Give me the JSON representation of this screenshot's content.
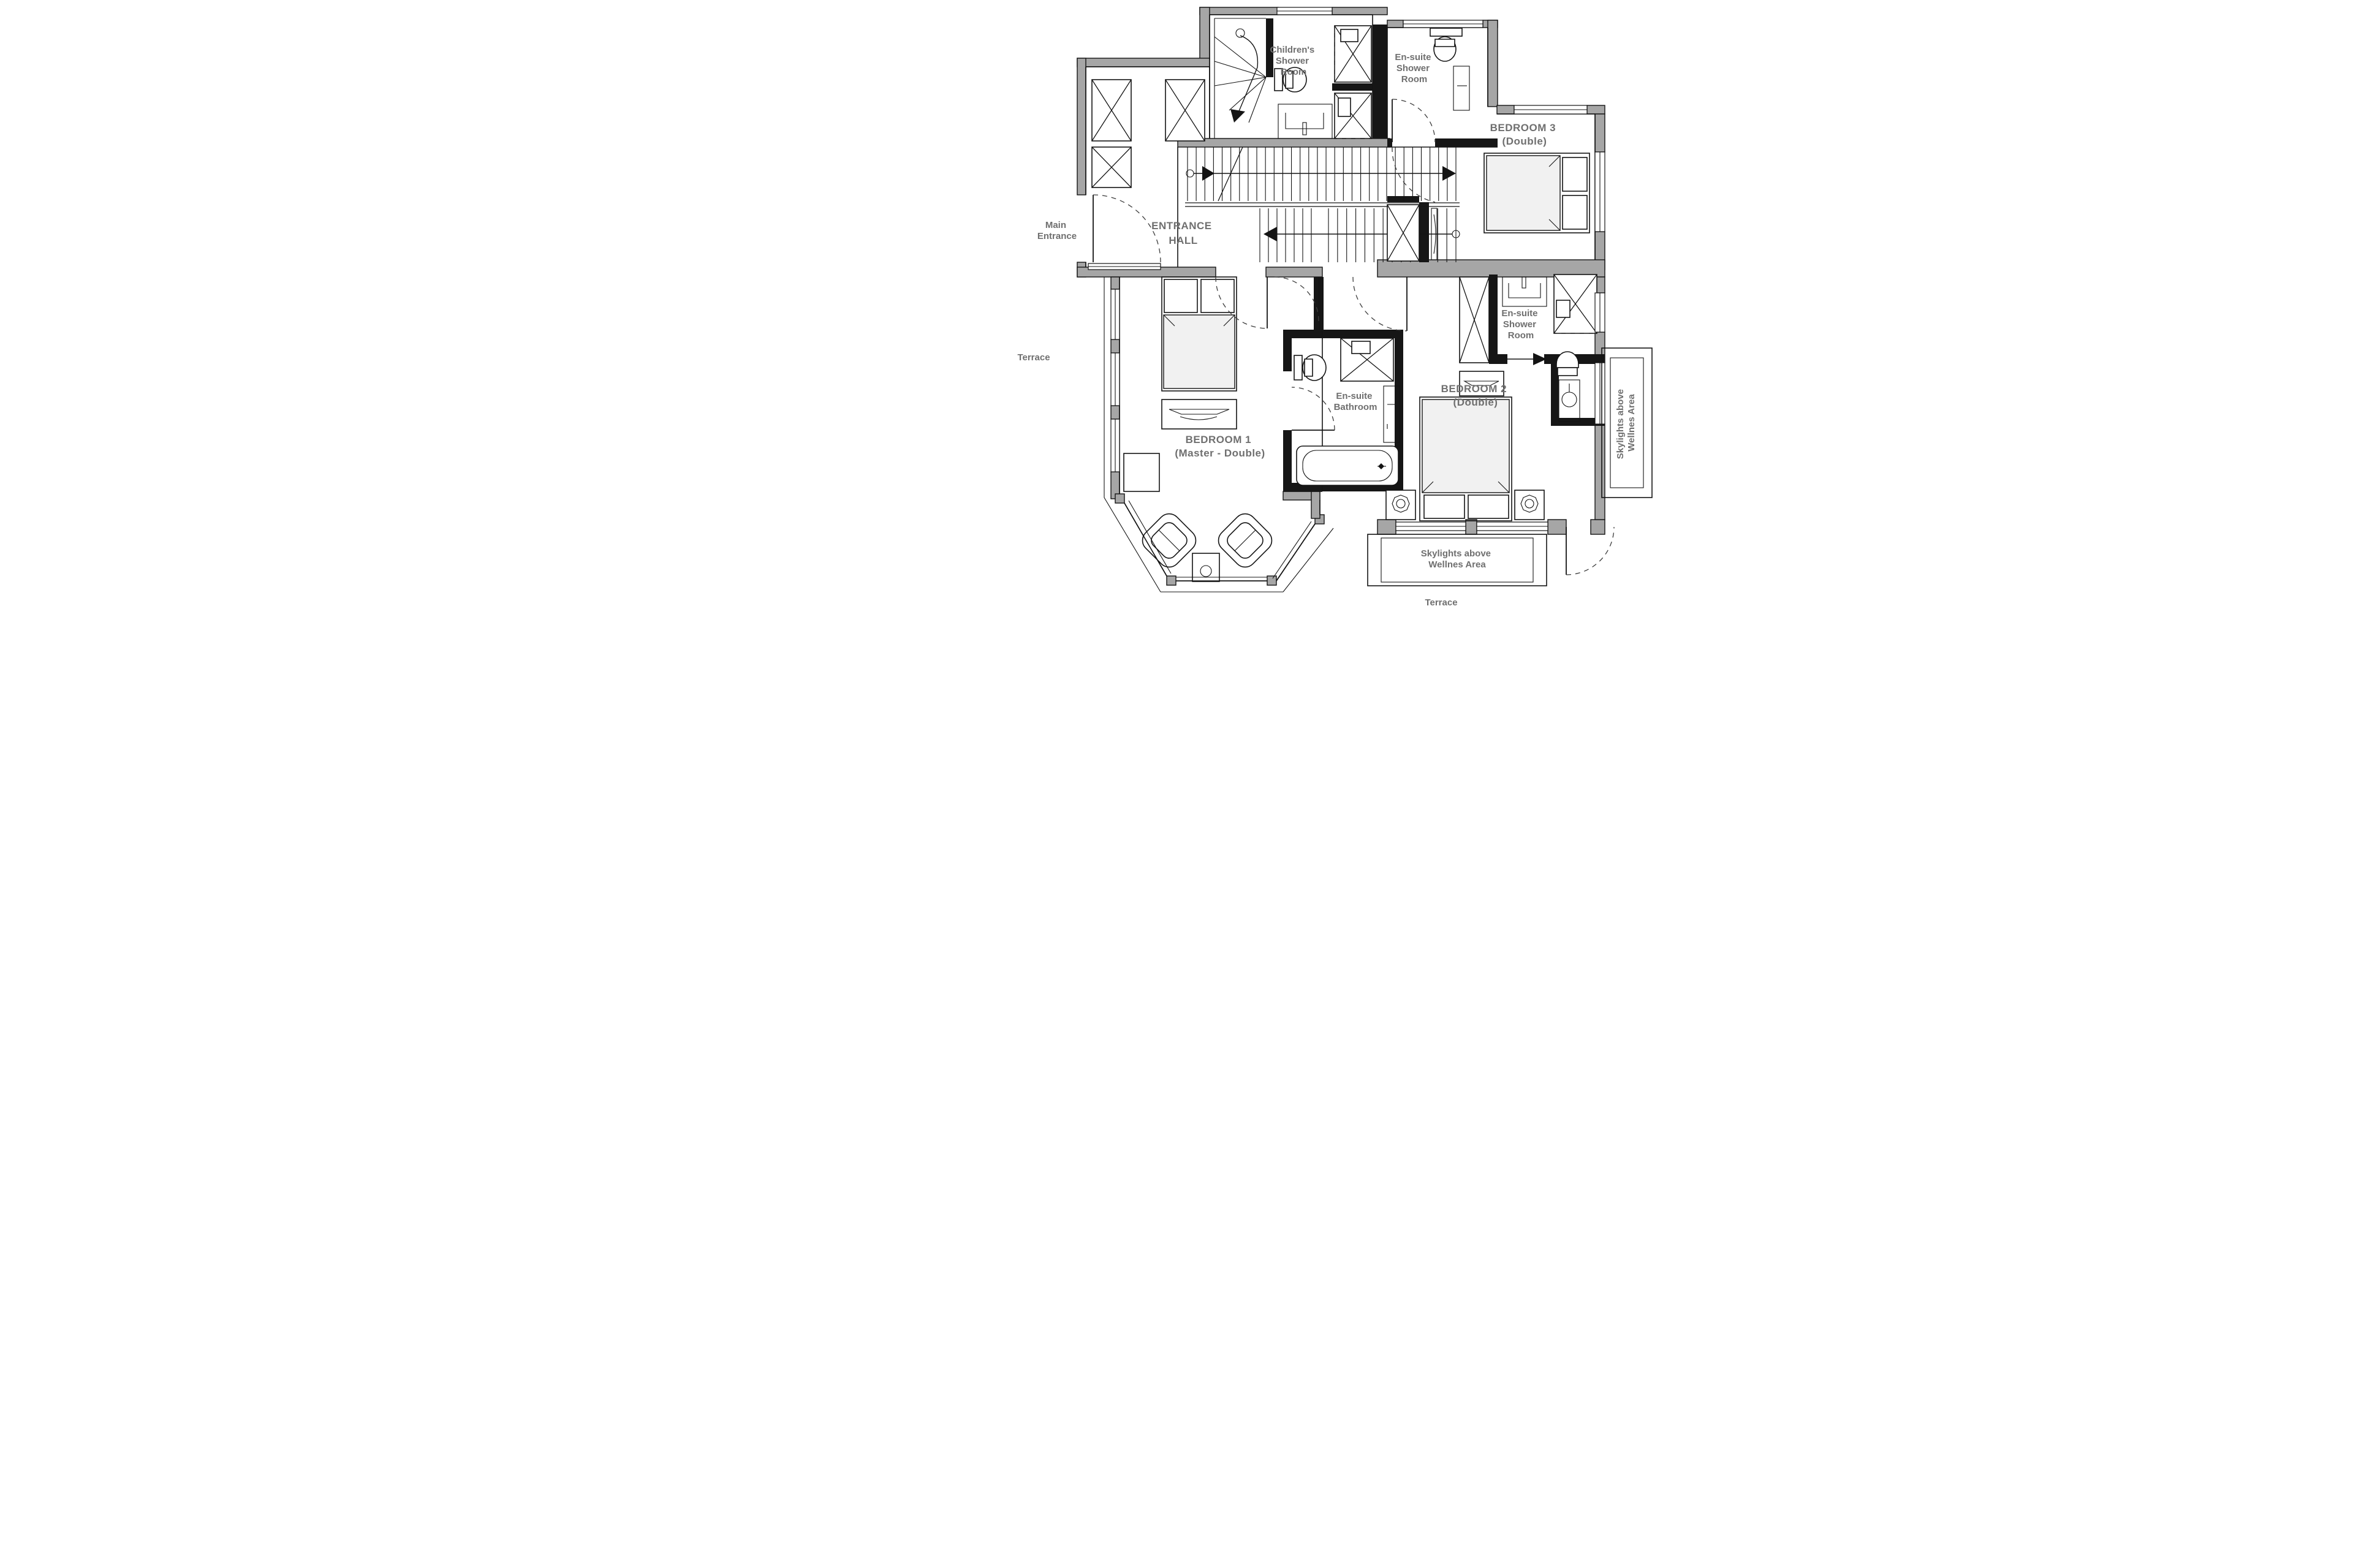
{
  "title": "Floor plan - bedroom level",
  "colors": {
    "wall_gray": "#a6a6a6",
    "wall_black": "#161616",
    "label_gray": "#6f6f6f",
    "furniture_fill": "#f1f1f1",
    "background": "#ffffff"
  },
  "rooms": {
    "children_shower": {
      "lines": [
        "Children's",
        "Shower",
        "Room"
      ]
    },
    "ensuite_shower_top": {
      "lines": [
        "En-suite",
        "Shower",
        "Room"
      ]
    },
    "bedroom3": {
      "lines": [
        "BEDROOM 3",
        "(Double)"
      ]
    },
    "entrance_hall": {
      "lines": [
        "ENTRANCE",
        "HALL"
      ]
    },
    "bedroom1": {
      "lines": [
        "BEDROOM 1",
        "(Master - Double)"
      ]
    },
    "ensuite_bathroom": {
      "lines": [
        "En-suite",
        "Bathroom"
      ]
    },
    "bedroom2": {
      "lines": [
        "BEDROOM 2",
        "(Double)"
      ]
    },
    "ensuite_shower_bed2": {
      "lines": [
        "En-suite",
        "Shower",
        "Room"
      ]
    }
  },
  "annotations": {
    "main_entrance": {
      "lines": [
        "Main",
        "Entrance"
      ]
    },
    "terrace_left": {
      "label": "Terrace"
    },
    "terrace_bottom": {
      "label": "Terrace"
    },
    "skylights_bottom": {
      "lines": [
        "Skylights above",
        "Wellnes Area"
      ]
    },
    "skylights_right": {
      "lines": [
        "Skylights above",
        "Wellnes Area"
      ]
    }
  }
}
